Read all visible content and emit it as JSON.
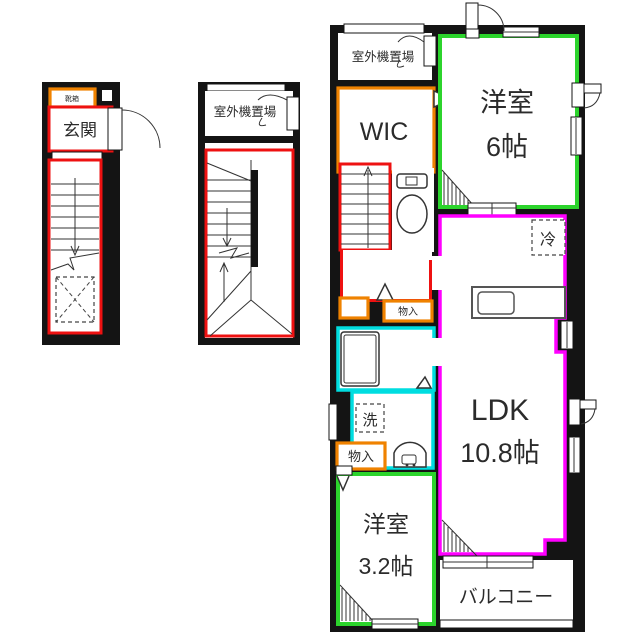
{
  "colors": {
    "wall": "#141414",
    "stairs_red": "#ee1111",
    "storage_orange": "#ef8200",
    "bedroom_green": "#2cd42c",
    "ldk_magenta": "#ff00ff",
    "bath_cyan": "#00dde0"
  },
  "plans": {
    "entrance": {
      "shoe_box": "靴箱",
      "genkan": "玄関"
    },
    "staircase": {
      "outdoor_unit": "室外機置場"
    },
    "main": {
      "outdoor_unit": "室外機置場",
      "wic": "WIC",
      "bedroom6_name": "洋室",
      "bedroom6_size": "6帖",
      "fridge": "冷",
      "ldk_name": "LDK",
      "ldk_size": "10.8帖",
      "washer": "洗",
      "storage_small": "物入",
      "storage": "物入",
      "bedroom3_name": "洋室",
      "bedroom3_size": "3.2帖",
      "balcony": "バルコニー"
    }
  }
}
